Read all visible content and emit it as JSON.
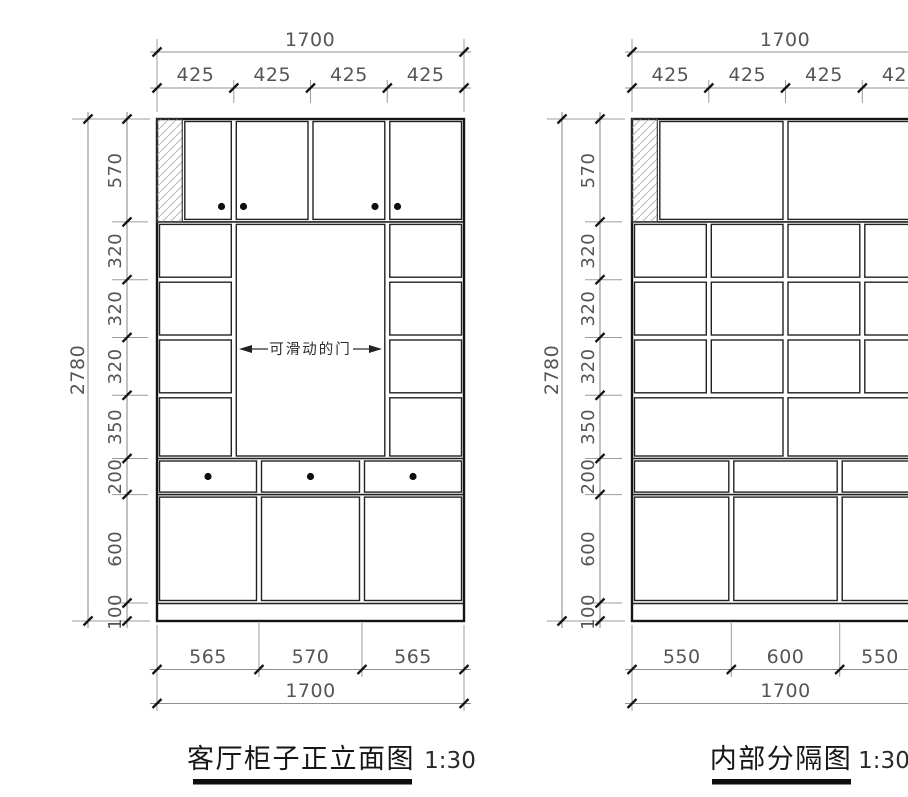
{
  "left": {
    "title": "客厅柜子正立面图",
    "scale": "1:30",
    "door_note": "可滑动的门",
    "dims": {
      "overall_width": "1700",
      "top_segments": [
        "425",
        "425",
        "425",
        "425"
      ],
      "overall_height": "2780",
      "side_segments": [
        "570",
        "320",
        "320",
        "320",
        "350",
        "200",
        "600",
        "100"
      ],
      "bottom_segments": [
        "565",
        "570",
        "565"
      ],
      "bottom_total": "1700"
    }
  },
  "right": {
    "title": "内部分隔图",
    "scale": "1:30",
    "dims": {
      "overall_width": "1700",
      "top_segments": [
        "425",
        "425",
        "425",
        "425"
      ],
      "overall_height": "2780",
      "side_segments": [
        "570",
        "320",
        "320",
        "320",
        "350",
        "200",
        "600",
        "100"
      ],
      "bottom_segments": [
        "550",
        "600",
        "550"
      ],
      "bottom_total": "1700"
    }
  },
  "colors": {
    "cabinet_line": "#1a1a1a",
    "dimension_line": "#8f8f8f",
    "dimension_text": "#555555",
    "knob": "#111111"
  }
}
